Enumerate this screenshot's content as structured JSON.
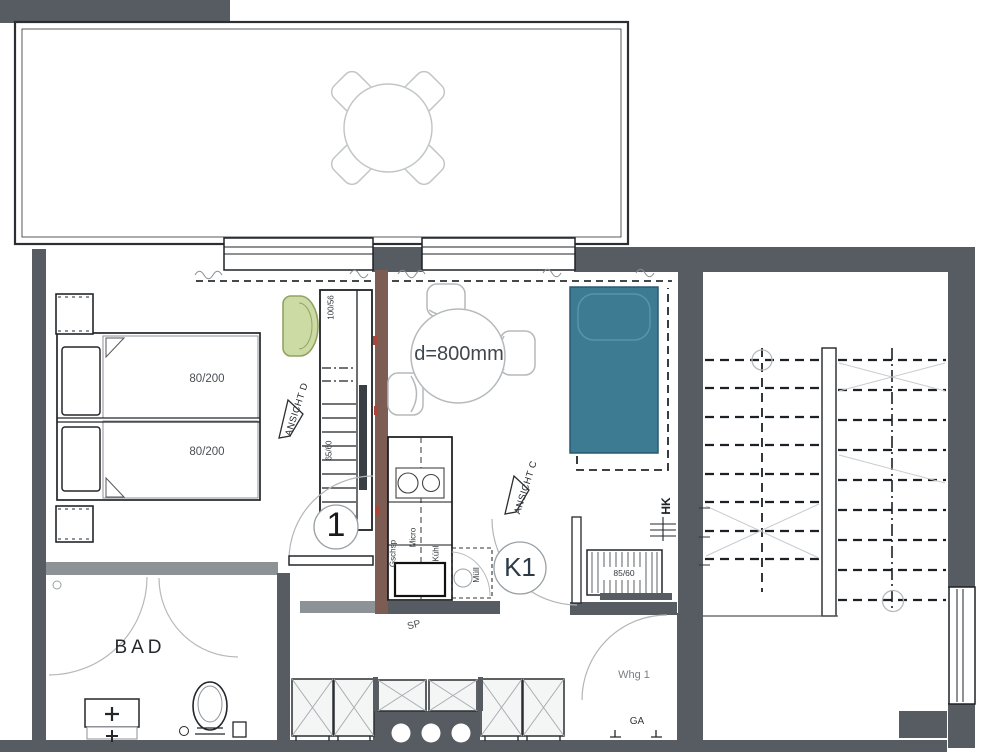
{
  "colors": {
    "wall": "#575c62",
    "wall_light": "#8d9297",
    "wall_brown": "#7d5c54",
    "sofa_teal": "#3d7b92",
    "armchair_green": "#ccdba4"
  },
  "bedroom": {
    "bed_top_label": "80/200",
    "bed_bottom_label": "80/200",
    "door_label": "1",
    "view_marker_d": "ANSICHT D",
    "shelf_dim_top": "100/56",
    "shelf_dim_bottom": "65/60"
  },
  "living_kitchen": {
    "table_dim_label": "d=800mm",
    "door_label": "K1",
    "view_marker_c": "ANSICHT C",
    "radiator_tag": "HK",
    "radiator_dim": "85/60",
    "sink_tag": "SP",
    "units": {
      "dishwasher": "Gschsp",
      "microwave": "Micro",
      "fridge": "Kühl",
      "waste": "Müll"
    }
  },
  "bathroom": {
    "room_label": "BAD"
  },
  "entry": {
    "apartment_label": "Whg 1",
    "threshold_tag": "GA"
  }
}
